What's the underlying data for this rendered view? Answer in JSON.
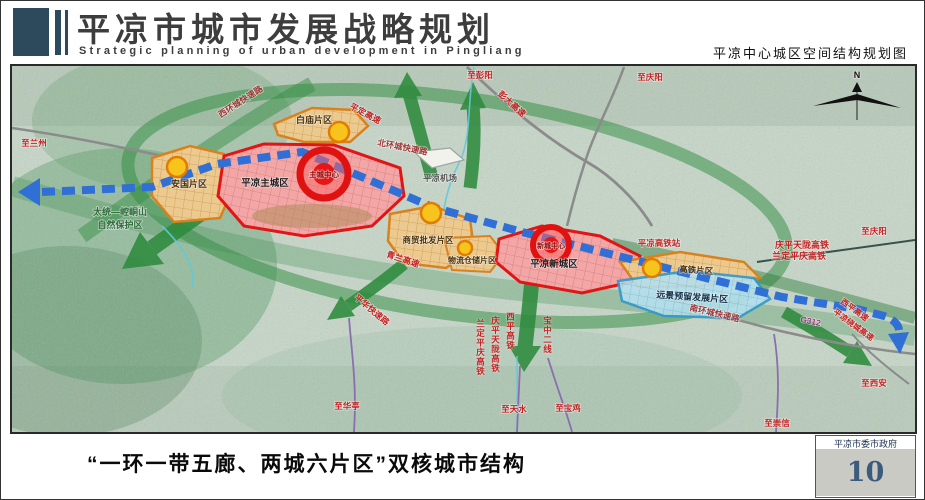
{
  "header": {
    "title": "平凉市城市发展战略规划",
    "subtitle_en": "Strategic planning of urban development in Pingliang",
    "map_title": "平凉中心城区空间结构规划图"
  },
  "map": {
    "north": "N",
    "zones": {
      "main_city": "平凉主城区",
      "new_city": "平凉新城区",
      "anguo": "安国片区",
      "baimiao": "白庙片区",
      "wholesale": "商贸批发片区",
      "logistics": "物流仓储片区",
      "hsr_district": "高铁片区",
      "reserved": "远景预留发展片区"
    },
    "cores": {
      "main_core": "主城中心",
      "new_core": "新城中心"
    },
    "labels": {
      "to_lanzhou": "至兰州",
      "to_pengyang": "至彭阳",
      "to_qingyang_top": "至庆阳",
      "to_qingyang_right": "至庆阳",
      "to_xian": "至西安",
      "to_chongxin": "至崇信",
      "to_huating": "至华亭",
      "to_tianshui": "至天水",
      "to_baoji": "至宝鸡",
      "nature_reserve_line1": "太统—崆峒山",
      "nature_reserve_line2": "自然保护区",
      "west_ring_road": "西环城快速路",
      "north_ring_road": "北环城快速路",
      "south_ring_road": "南环城快速路",
      "pinghua_expressway": "平华快速路",
      "pengda_expressway": "彭大高速",
      "pingding_expressway": "平定高速",
      "qinglan_expressway": "青兰高速",
      "xiping_expressway": "西平高速",
      "raocheng_expressway": "平凉绕城高速",
      "g312": "G312",
      "qingping_tianlong_hsr": "庆平天陇高铁",
      "landing_pingqing_hsr": "兰定平庆高铁",
      "xiping_hsr": "西平高铁",
      "baozhong_line2": "宝中二线",
      "airport": "平凉机场",
      "hsr_station": "平凉高铁站"
    }
  },
  "footer": {
    "caption": "“一环一带五廊、两城六片区”双核城市结构",
    "agency": "平凉市委市政府",
    "page_number": "10"
  },
  "colors": {
    "accent_dark": "#2d4a5c",
    "zone_red": "#e01515",
    "zone_orange": "#d8821e",
    "zone_blue": "#3399cc",
    "corridor_green": "#2e8b3d",
    "axis_blue": "#2f6fd6",
    "label_red": "#c42222",
    "page_number_color": "#3c5a7c"
  }
}
